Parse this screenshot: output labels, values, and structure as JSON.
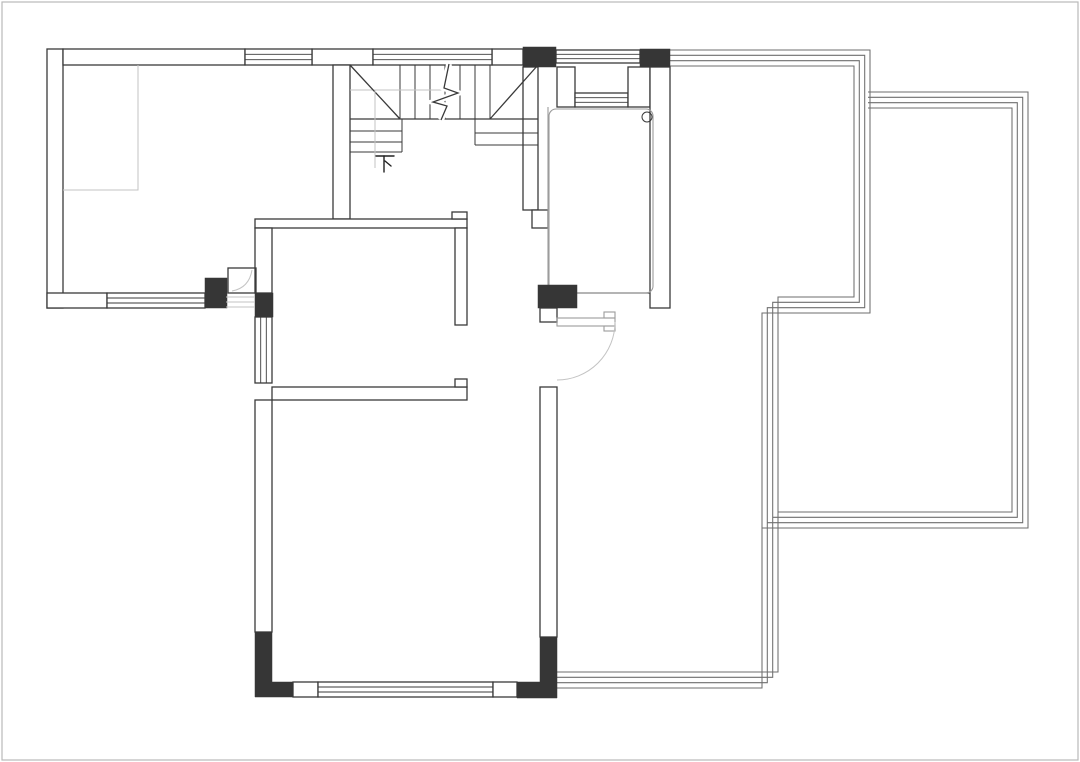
{
  "drawing": {
    "type": "architectural-floor-plan",
    "stairs_label": "下",
    "colors": {
      "background": "#ffffff",
      "line": "#3a3a3a",
      "column_fill": "#363636",
      "light_line": "#c3c3c3",
      "railing_line": "#6e6e6e",
      "soft_line": "#9c9c9c",
      "frame": "#b9b9b9"
    }
  }
}
